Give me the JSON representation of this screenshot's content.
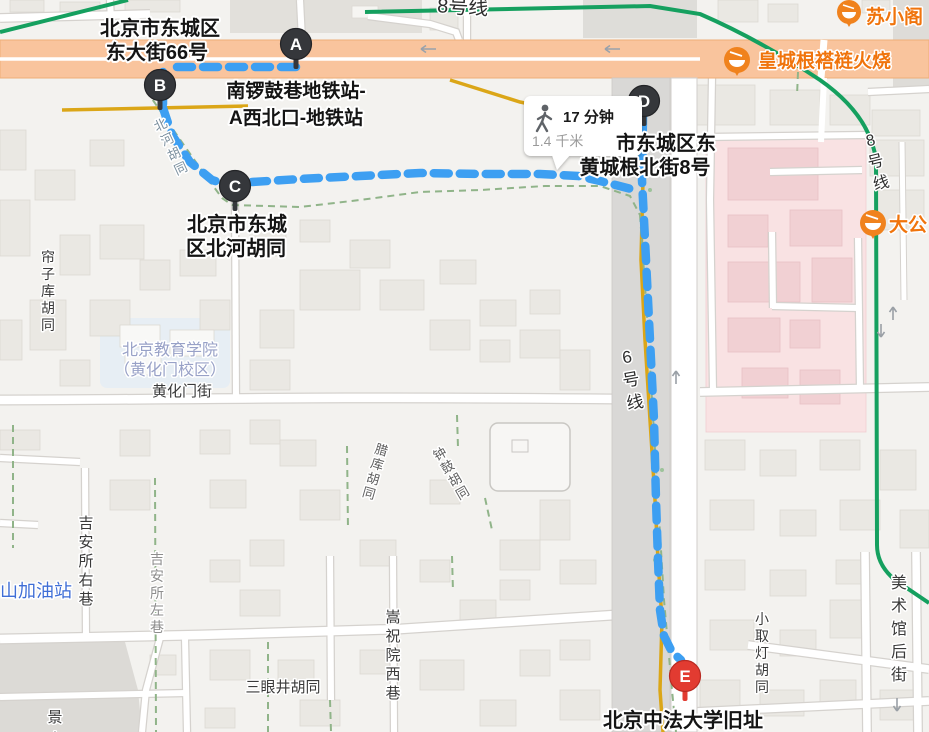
{
  "route": {
    "duration": "17 分钟",
    "distance": "1.4 千米",
    "markers": [
      "A",
      "B",
      "C",
      "D",
      "E"
    ]
  },
  "addresses": {
    "a_line1": "北京市东城区",
    "a_line2": "东大街66号",
    "station_line1": "南锣鼓巷地铁站-",
    "station_line2": "A西北口-地铁站",
    "c_line1": "北京市东城",
    "c_line2": "区北河胡同",
    "d_line1": "市东城区东",
    "d_line2": "黄城根北街8号",
    "e": "北京中法大学旧址"
  },
  "pois": {
    "huangchenggen": "皇城根褡裢火烧",
    "suxiaoge": "苏小阁",
    "dagong": "大公",
    "gas_station": "山加油站",
    "edu_line1": "北京教育学院",
    "edu_line2": "（黄化门校区）"
  },
  "streets": {
    "lianzi_ku": "帘子库胡同",
    "huanghuamen": "黄化门街",
    "jian_right": "吉安所右巷",
    "jian_left": "吉安所左巷",
    "sanyanjing": "三眼井胡同",
    "songzhuyuan": "嵩祝院西巷",
    "xiaoqudeng": "小取灯胡同",
    "meishuguan": "美术馆后街",
    "jingshan_partial": "景山",
    "beihe": "北河胡同",
    "laku": "腊库胡同",
    "zhonggu": "钟鼓胡同"
  },
  "transit": {
    "line6": "6号线",
    "line8_right": "8号线",
    "line8_top": "8号线"
  },
  "colors": {
    "route_blue": "#3d9ff2",
    "marker_dark": "#35373b",
    "marker_red": "#e23b31",
    "poi_orange": "#f07d12",
    "line8_green": "#15a05f",
    "line6_gold": "#dba617",
    "major_road_orange": "#f9c49d"
  }
}
